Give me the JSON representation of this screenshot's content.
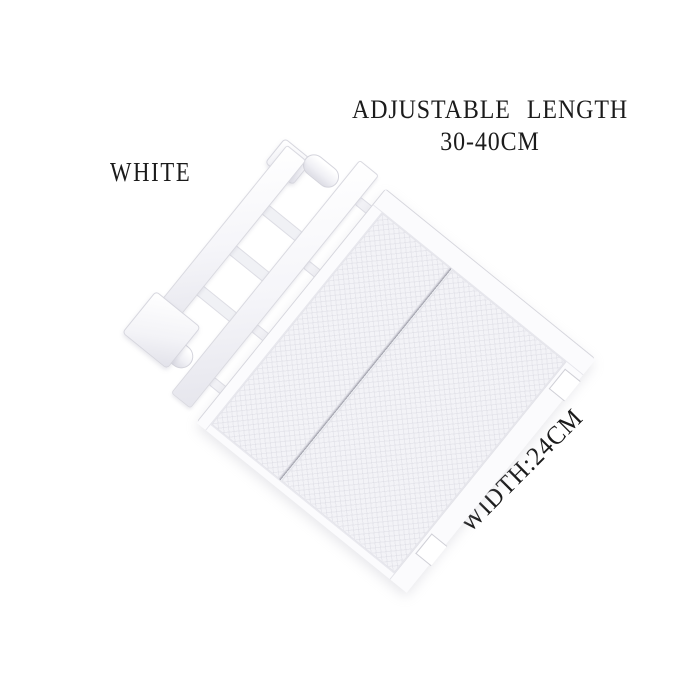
{
  "labels": {
    "length_note_line1": "ADJUSTABLE LENGTH",
    "length_note_line2": "30-40CM",
    "color_note": "WHITE",
    "width_note": "WIDTH:24CM"
  },
  "colors": {
    "background": "#ffffff",
    "product_white": "#f5f5f8",
    "shadow_gray": "#d9d9e0",
    "text": "#1b1b1b"
  },
  "product": {
    "kind": "adjustable-closet-shelf-organizer"
  }
}
